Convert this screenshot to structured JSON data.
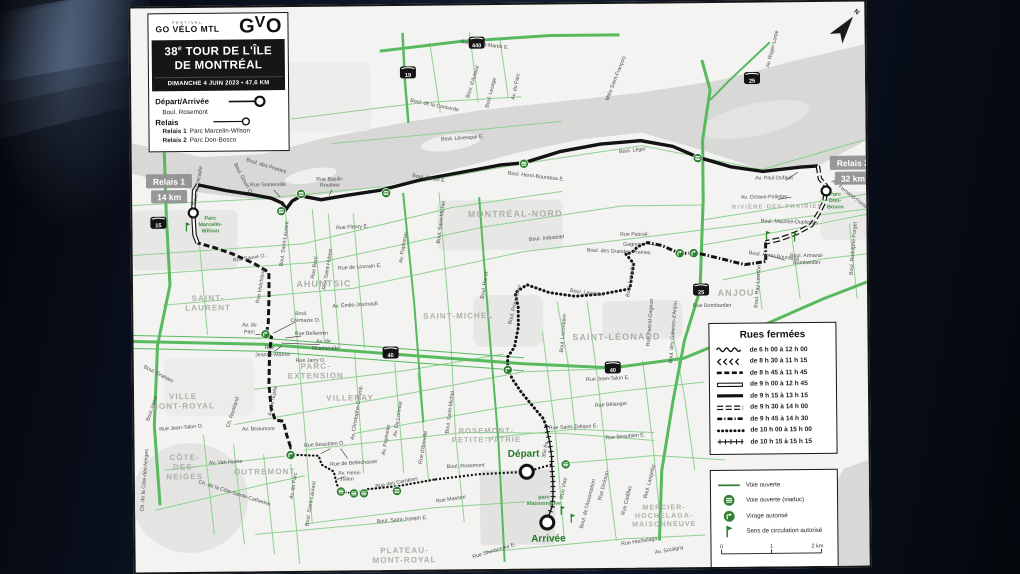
{
  "header": {
    "festival": "FESTIVAL",
    "logo_main": "GO VÉLO MTL",
    "logo_mark_g": "G",
    "logo_mark_v": "V",
    "logo_mark_o": "O",
    "title_num": "38",
    "title_sup": "e",
    "title_rest": " TOUR DE L'ÎLE",
    "title_line2": "DE MONTRÉAL",
    "subtitle": "DIMANCHE 4 JUIN 2023 • 47,6 KM",
    "legend": {
      "depart_label": "Départ/Arrivée",
      "depart_street": "Boul. Rosemont",
      "relais_label": "Relais",
      "relais1": "Relais 1",
      "relais1_loc": "Parc Marcelin-Wilson",
      "relais2": "Relais 2",
      "relais2_loc": "Parc Don-Bosco"
    }
  },
  "closures": {
    "title": "Rues fermées",
    "rows": [
      {
        "style": "wavy",
        "label": "de 6 h 00 à 12 h 00"
      },
      {
        "style": "arrows",
        "label": "de 8 h 30 à 11 h 15"
      },
      {
        "style": "dash-bold",
        "label": "de 8 h 45 à 11 h 45"
      },
      {
        "style": "hollow",
        "label": "de 9 h 00 à 12 h 45"
      },
      {
        "style": "solid",
        "label": "de 9 h 15 à 13 h 15"
      },
      {
        "style": "hollow-dash",
        "label": "de 9 h 30 à 14 h 00"
      },
      {
        "style": "dash-dot",
        "label": "de 9 h 45 à 14 h 30"
      },
      {
        "style": "dots",
        "label": "de 10 h 00 à 15 h 00"
      },
      {
        "style": "cross",
        "label": "de 10 h 15 à 15 h 15"
      }
    ]
  },
  "info_legend": {
    "items": [
      {
        "icon": "line",
        "label": "Voie ouverte"
      },
      {
        "icon": "viaduc",
        "label": "Voie ouverte (viaduc)"
      },
      {
        "icon": "virage",
        "label": "Virage autorisé"
      },
      {
        "icon": "sens",
        "label": "Sens de circulation autorisé"
      }
    ],
    "scale": {
      "ticks": [
        "0",
        "1",
        "2 km"
      ]
    },
    "sources": "Sources 2023 : Adresses Québec, Ville Québec, CanVec"
  },
  "map": {
    "north_label": "N",
    "accent_green": "#2f8132",
    "route_black": "#131313",
    "badges": [
      {
        "l1": "Relais 1",
        "l2": "14 km",
        "x": 14,
        "y": 166
      },
      {
        "l1": "Relais 2",
        "l2": "32 km",
        "x": 698,
        "y": 154
      }
    ],
    "route_labels": [
      {
        "t": "Départ",
        "x": 389,
        "y": 452
      },
      {
        "t": "Arrivée",
        "x": 413,
        "y": 537
      }
    ],
    "shields": [
      {
        "n": "15",
        "x": 26,
        "y": 215
      },
      {
        "n": "19",
        "x": 277,
        "y": 67
      },
      {
        "n": "440",
        "x": 346,
        "y": 38
      },
      {
        "n": "25",
        "x": 621,
        "y": 76
      },
      {
        "n": "25",
        "x": 568,
        "y": 287
      },
      {
        "n": "40",
        "x": 257,
        "y": 347
      },
      {
        "n": "40",
        "x": 479,
        "y": 364
      }
    ],
    "districts": [
      {
        "lines": [
          "SAINT-",
          "LAURENT"
        ],
        "x": 75,
        "y": 293,
        "s": 8
      },
      {
        "lines": [
          "VILLE",
          "MONT-ROYAL"
        ],
        "x": 49,
        "y": 391,
        "s": 8
      },
      {
        "lines": [
          "PARC-",
          "EXTENSION"
        ],
        "x": 182,
        "y": 362,
        "s": 8
      },
      {
        "lines": [
          "VILLERAY"
        ],
        "x": 216,
        "y": 394,
        "s": 8
      },
      {
        "lines": [
          "AHUNTSIC"
        ],
        "x": 191,
        "y": 280,
        "s": 9
      },
      {
        "lines": [
          "MONTRÉAL-NORD"
        ],
        "x": 383,
        "y": 212,
        "s": 9
      },
      {
        "lines": [
          "SAINT-MICHEL"
        ],
        "x": 325,
        "y": 313,
        "s": 8
      },
      {
        "lines": [
          "SAINT-LÉONARD"
        ],
        "x": 483,
        "y": 336,
        "s": 9
      },
      {
        "lines": [
          "ANJOU"
        ],
        "x": 603,
        "y": 293,
        "s": 9
      },
      {
        "lines": [
          "RIVIÈRE-DES-PRAIRIES"
        ],
        "x": 645,
        "y": 206,
        "s": 6
      },
      {
        "lines": [
          "OUTREMONT"
        ],
        "x": 130,
        "y": 467,
        "s": 8
      },
      {
        "lines": [
          "CÔTE-",
          "DES-",
          "NEIGES"
        ],
        "x": 50,
        "y": 452,
        "s": 8
      },
      {
        "lines": [
          "PLATEAU-",
          "MONT-ROYAL"
        ],
        "x": 269,
        "y": 547,
        "s": 8
      },
      {
        "lines": [
          "MERCIER-",
          "HOCHELAGA-",
          "MAISONNEUVE"
        ],
        "x": 529,
        "y": 506,
        "s": 7
      },
      {
        "lines": [
          "ROSEMONT-",
          "PETITE-PATRIE"
        ],
        "x": 352,
        "y": 428,
        "s": 7.5
      }
    ],
    "parks": [
      {
        "lines": [
          "Parc",
          "Marcelin-",
          "Wilson"
        ],
        "x": 78,
        "y": 212
      },
      {
        "lines": [
          "Parc",
          "Don-",
          "Bosco"
        ],
        "x": 703,
        "y": 194
      },
      {
        "lines": [
          "parc",
          "Maisonneuve"
        ],
        "x": 409,
        "y": 494
      }
    ],
    "streets": [
      {
        "t": "Boul. Gouin O.",
        "x": 110,
        "y": 172,
        "r": 62
      },
      {
        "t": "Boul. des Prairies",
        "x": 134,
        "y": 160,
        "r": 18
      },
      {
        "t": "Rue Somerville",
        "x": 136,
        "y": 179
      },
      {
        "t": "Rue Basile-",
        "x": 198,
        "y": 174
      },
      {
        "t": "Routhier",
        "x": 198,
        "y": 180
      },
      {
        "t": "Boul. Lévesque E.",
        "x": 331,
        "y": 134,
        "r": -3
      },
      {
        "t": "Boul. Saint-Martin E.",
        "x": 354,
        "y": 41,
        "r": 8
      },
      {
        "t": "Boul. d'Auteuil",
        "x": 343,
        "y": 77,
        "r": -72
      },
      {
        "t": "Boul. Lesage",
        "x": 361,
        "y": 88,
        "r": -75
      },
      {
        "t": "Av. du Parc",
        "x": 386,
        "y": 82,
        "r": -78
      },
      {
        "t": "Mtée Saint-François",
        "x": 486,
        "y": 75,
        "r": -68
      },
      {
        "t": "Boul. de la Concorde",
        "x": 303,
        "y": 101,
        "r": 12
      },
      {
        "t": "Av. Roger-Lortie",
        "x": 643,
        "y": 47,
        "r": -75
      },
      {
        "t": "Boul. Gouin E.",
        "x": 297,
        "y": 174,
        "r": 10
      },
      {
        "t": "Boul. Léger",
        "x": 501,
        "y": 148,
        "r": -6
      },
      {
        "t": "Boul. Henri-Bourassa E.",
        "x": 404,
        "y": 173,
        "r": 7
      },
      {
        "t": "Rue Fleury E.",
        "x": 220,
        "y": 222,
        "r": -3
      },
      {
        "t": "Rue Sauvé O.",
        "x": 117,
        "y": 252,
        "r": -8
      },
      {
        "t": "Boul. de l'Acadie",
        "x": 67,
        "y": 178,
        "r": -80
      },
      {
        "t": "Boul. Saint-Laurent",
        "x": 153,
        "y": 237,
        "r": -82
      },
      {
        "t": "Rue Hutchison",
        "x": 129,
        "y": 279,
        "r": -80
      },
      {
        "t": "Rue Berri",
        "x": 183,
        "y": 261,
        "r": -80
      },
      {
        "t": "Rue Saint-Hubert",
        "x": 196,
        "y": 263,
        "r": -80
      },
      {
        "t": "Av. Papineau",
        "x": 272,
        "y": 242,
        "r": -80
      },
      {
        "t": "Boul. Saint-Michel",
        "x": 310,
        "y": 217,
        "r": -82
      },
      {
        "t": "Rue de Louvain E.",
        "x": 227,
        "y": 262,
        "r": -3
      },
      {
        "t": "Av. Émile-Journault",
        "x": 222,
        "y": 300,
        "r": -3
      },
      {
        "t": "Boul. Industriel",
        "x": 414,
        "y": 235,
        "r": -4
      },
      {
        "t": "Boul. Maurice-Duplessis",
        "x": 657,
        "y": 221,
        "r": 2
      },
      {
        "t": "Av. Paul-Dufault",
        "x": 642,
        "y": 177
      },
      {
        "t": "Av. Octave-Pelletier",
        "x": 632,
        "y": 196
      },
      {
        "t": "Av. Fernand-Forest",
        "x": 717,
        "y": 194,
        "r": 38
      },
      {
        "t": "Boul. Rodolphe-Forget",
        "x": 722,
        "y": 247,
        "r": -85
      },
      {
        "t": "Boul. Henri-Bourassa",
        "x": 641,
        "y": 255,
        "r": 8
      },
      {
        "t": "Boul. Armand-",
        "x": 674,
        "y": 255
      },
      {
        "t": "Bombardier",
        "x": 674,
        "y": 262
      },
      {
        "t": "Rue Pascal-",
        "x": 502,
        "y": 232
      },
      {
        "t": "Gagnon",
        "x": 500,
        "y": 242
      },
      {
        "t": "Boul. des Grandes-Prairies",
        "x": 486,
        "y": 249,
        "r": 3
      },
      {
        "t": "Rue Bombardier",
        "x": 579,
        "y": 304
      },
      {
        "t": "Boul. Ray-Lawson",
        "x": 626,
        "y": 284,
        "r": -85
      },
      {
        "t": "Boul. Lavoisier",
        "x": 454,
        "y": 290,
        "r": 8
      },
      {
        "t": "Boul. Provencher",
        "x": 383,
        "y": 300,
        "r": -75
      },
      {
        "t": "Boul. Lacordaire",
        "x": 431,
        "y": 329,
        "r": -85
      },
      {
        "t": "Rue Pascal-Gagnon",
        "x": 518,
        "y": 319,
        "r": -85
      },
      {
        "t": "Boul. des Galeries-d'Anjou",
        "x": 541,
        "y": 329,
        "r": -85
      },
      {
        "t": "Boul. Langelier",
        "x": 499,
        "y": 276,
        "r": -80
      },
      {
        "t": "Boul. Pie-IX",
        "x": 353,
        "y": 280,
        "r": -80
      },
      {
        "t": "Boul.",
        "x": 168,
        "y": 308
      },
      {
        "t": "Crémazie O.",
        "x": 172,
        "y": 315
      },
      {
        "t": "Rue Bellarmin",
        "x": 178,
        "y": 328
      },
      {
        "t": "Av. de",
        "x": 190,
        "y": 336
      },
      {
        "t": "l'Esplanade",
        "x": 192,
        "y": 343
      },
      {
        "t": "Av. du",
        "x": 116,
        "y": 319
      },
      {
        "t": "Parc",
        "x": 116,
        "y": 326
      },
      {
        "t": "Rue",
        "x": 136,
        "y": 342
      },
      {
        "t": "Jeanne-Mance",
        "x": 139,
        "y": 349
      },
      {
        "t": "Rue Jarry O.",
        "x": 177,
        "y": 355
      },
      {
        "t": "Rue Jean-Talon E.",
        "x": 474,
        "y": 376,
        "r": -2
      },
      {
        "t": "Rue Bélanger",
        "x": 477,
        "y": 402,
        "r": -3
      },
      {
        "t": "Rue Saint-Zotique E.",
        "x": 439,
        "y": 424,
        "r": -2
      },
      {
        "t": "Rue Beaubien E.",
        "x": 491,
        "y": 434,
        "r": -4
      },
      {
        "t": "Boul. Rosemont",
        "x": 331,
        "y": 462,
        "r": -2
      },
      {
        "t": "Rue des Carrières",
        "x": 262,
        "y": 478,
        "r": -10
      },
      {
        "t": "Rue Masson",
        "x": 316,
        "y": 495,
        "r": -8
      },
      {
        "t": "Boul. Saint-Joseph E.",
        "x": 267,
        "y": 515,
        "r": -4
      },
      {
        "t": "Rue Sherbrooke E.",
        "x": 359,
        "y": 547,
        "r": -16
      },
      {
        "t": "Rue Hochelaga",
        "x": 504,
        "y": 539,
        "r": -8
      },
      {
        "t": "Av. Souligny",
        "x": 534,
        "y": 548,
        "r": -10
      },
      {
        "t": "Rue Beaubien O.",
        "x": 190,
        "y": 439,
        "r": -3
      },
      {
        "t": "Rue de Bellechasse",
        "x": 219,
        "y": 458,
        "r": -3
      },
      {
        "t": "Av. Henri-",
        "x": 215,
        "y": 468
      },
      {
        "t": "Julien",
        "x": 212,
        "y": 474
      },
      {
        "t": "Av. Beaumont",
        "x": 124,
        "y": 423
      },
      {
        "t": "Av. de l'Épée",
        "x": 140,
        "y": 394,
        "r": -78
      },
      {
        "t": "Av. du Parc",
        "x": 160,
        "y": 479,
        "r": -80
      },
      {
        "t": "Boul. Saint-Laurent",
        "x": 177,
        "y": 497,
        "r": -80
      },
      {
        "t": "Av. Christophe-Colomb",
        "x": 224,
        "y": 407,
        "r": -80
      },
      {
        "t": "Av. Papineau",
        "x": 253,
        "y": 434,
        "r": -80
      },
      {
        "t": "Av. De Lorimier",
        "x": 265,
        "y": 413,
        "r": -80
      },
      {
        "t": "Rue d'Iberville",
        "x": 290,
        "y": 442,
        "r": -80
      },
      {
        "t": "Boul. Saint-Michel",
        "x": 317,
        "y": 407,
        "r": -82
      },
      {
        "t": "35e Av.",
        "x": 412,
        "y": 445,
        "r": -80
      },
      {
        "t": "Rue Viau",
        "x": 430,
        "y": 484,
        "r": -80
      },
      {
        "t": "Boul. de l'Assomption",
        "x": 454,
        "y": 500,
        "r": -75
      },
      {
        "t": "Rue Dickson",
        "x": 470,
        "y": 482,
        "r": -75
      },
      {
        "t": "Rue Cadillac",
        "x": 493,
        "y": 497,
        "r": -75
      },
      {
        "t": "Boul. Langelier",
        "x": 516,
        "y": 478,
        "r": -75
      },
      {
        "t": "Av. Van Horne",
        "x": 91,
        "y": 456,
        "r": -2
      },
      {
        "t": "Rue Jean-Talon O.",
        "x": 47,
        "y": 421,
        "r": -4
      },
      {
        "t": "Ch. de la Côte-Sainte-Catherine",
        "x": 99,
        "y": 487,
        "r": 18
      },
      {
        "t": "Ch. de la Côte-des-Neiges",
        "x": 11,
        "y": 472,
        "r": -85
      },
      {
        "t": "Boul. Laird",
        "x": 19,
        "y": 401,
        "r": -70
      },
      {
        "t": "Ch. Rockland",
        "x": 100,
        "y": 405,
        "r": -72
      },
      {
        "t": "Boul. Graham",
        "x": 24,
        "y": 367,
        "r": 28
      }
    ],
    "markers": {
      "viaduc": [
        [
          149,
          204
        ],
        [
          169,
          187
        ],
        [
          254,
          187
        ],
        [
          392,
          159
        ],
        [
          566,
          155
        ],
        [
          206,
          485
        ],
        [
          219,
          487
        ],
        [
          229,
          487
        ],
        [
          262,
          485
        ],
        [
          431,
          460
        ]
      ],
      "virage": [
        [
          132,
          327
        ],
        [
          156,
          448
        ],
        [
          374,
          365
        ],
        [
          547,
          250
        ],
        [
          561,
          250
        ]
      ],
      "sens": [
        [
          54,
          219
        ],
        [
          634,
          233
        ],
        [
          662,
          235
        ],
        [
          426,
          506
        ],
        [
          436,
          514
        ]
      ],
      "checkpoints": [
        {
          "x": 392,
          "y": 467,
          "rad": 6.5
        },
        {
          "x": 412,
          "y": 518,
          "rad": 6.5
        },
        {
          "x": 61,
          "y": 205,
          "rad": 4.5
        },
        {
          "x": 694,
          "y": 189,
          "rad": 4.5
        }
      ]
    }
  }
}
